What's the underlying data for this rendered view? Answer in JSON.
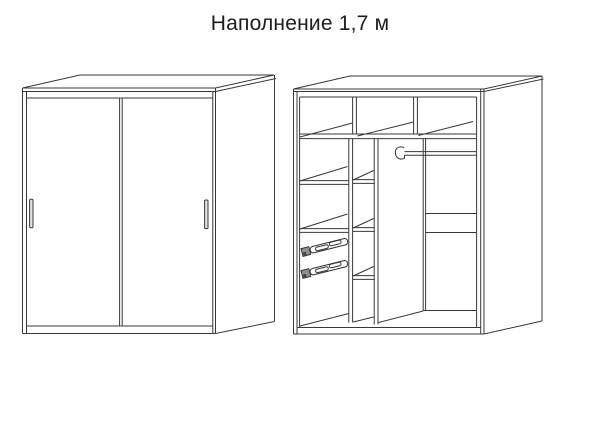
{
  "title": "Наполнение 1,7 м",
  "colors": {
    "background": "#ffffff",
    "line": "#383838",
    "handle_fill": "#e0e0e0",
    "slide_block_fill": "#909090"
  }
}
